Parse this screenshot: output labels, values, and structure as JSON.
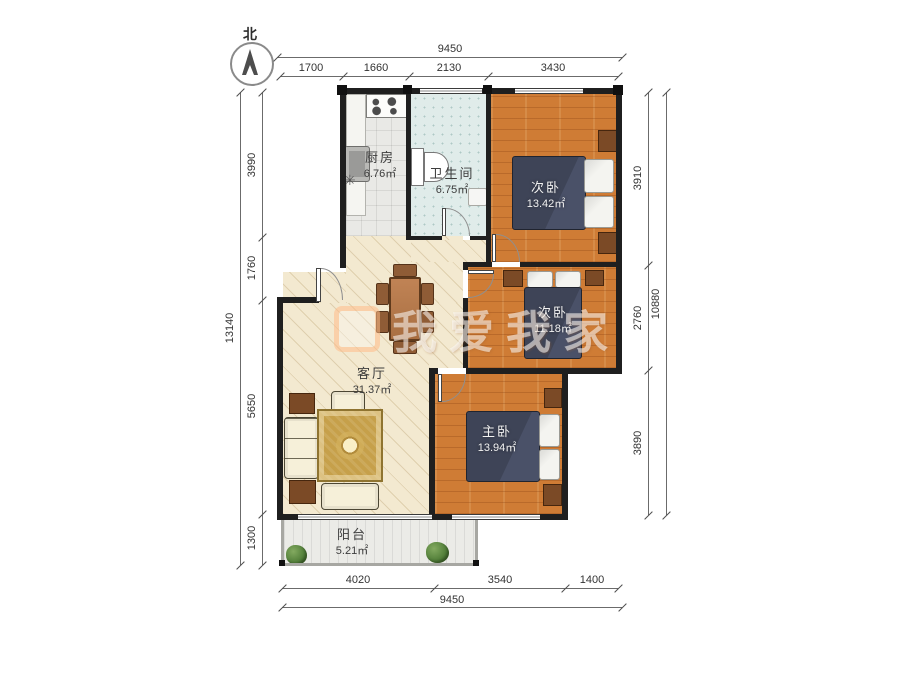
{
  "compass": {
    "label": "北"
  },
  "rooms": {
    "kitchen": {
      "name": "厨房",
      "area": "6.76㎡"
    },
    "bathroom": {
      "name": "卫生间",
      "area": "6.75㎡"
    },
    "bedroom_top": {
      "name": "次卧",
      "area": "13.42㎡"
    },
    "bedroom_mid": {
      "name": "次卧",
      "area": "11.18㎡"
    },
    "living_room": {
      "name": "客厅",
      "area": "31.37㎡"
    },
    "master_bedroom": {
      "name": "主卧",
      "area": "13.94㎡"
    },
    "balcony": {
      "name": "阳台",
      "area": "5.21㎡"
    }
  },
  "dimensions": {
    "top": {
      "total": "9450",
      "segments": [
        "1700",
        "1660",
        "2130",
        "3430"
      ]
    },
    "left": {
      "total": "13140",
      "segments": [
        "3990",
        "1760",
        "5650",
        "1300"
      ]
    },
    "right": {
      "total": "10880",
      "segments": [
        "3910",
        "2760",
        "3890"
      ]
    },
    "bottom": {
      "total": "9450",
      "segments": [
        "4020",
        "3540",
        "1400"
      ]
    }
  },
  "watermark": {
    "text": "我爱我家"
  },
  "symbols": {
    "floor_drain": "✳"
  },
  "colors": {
    "wall": "#1f1f1f",
    "wood_floor": "#cf7c35",
    "living_floor": "#f3e9d0",
    "bed": "#3e4457",
    "dim_text": "#333333"
  }
}
